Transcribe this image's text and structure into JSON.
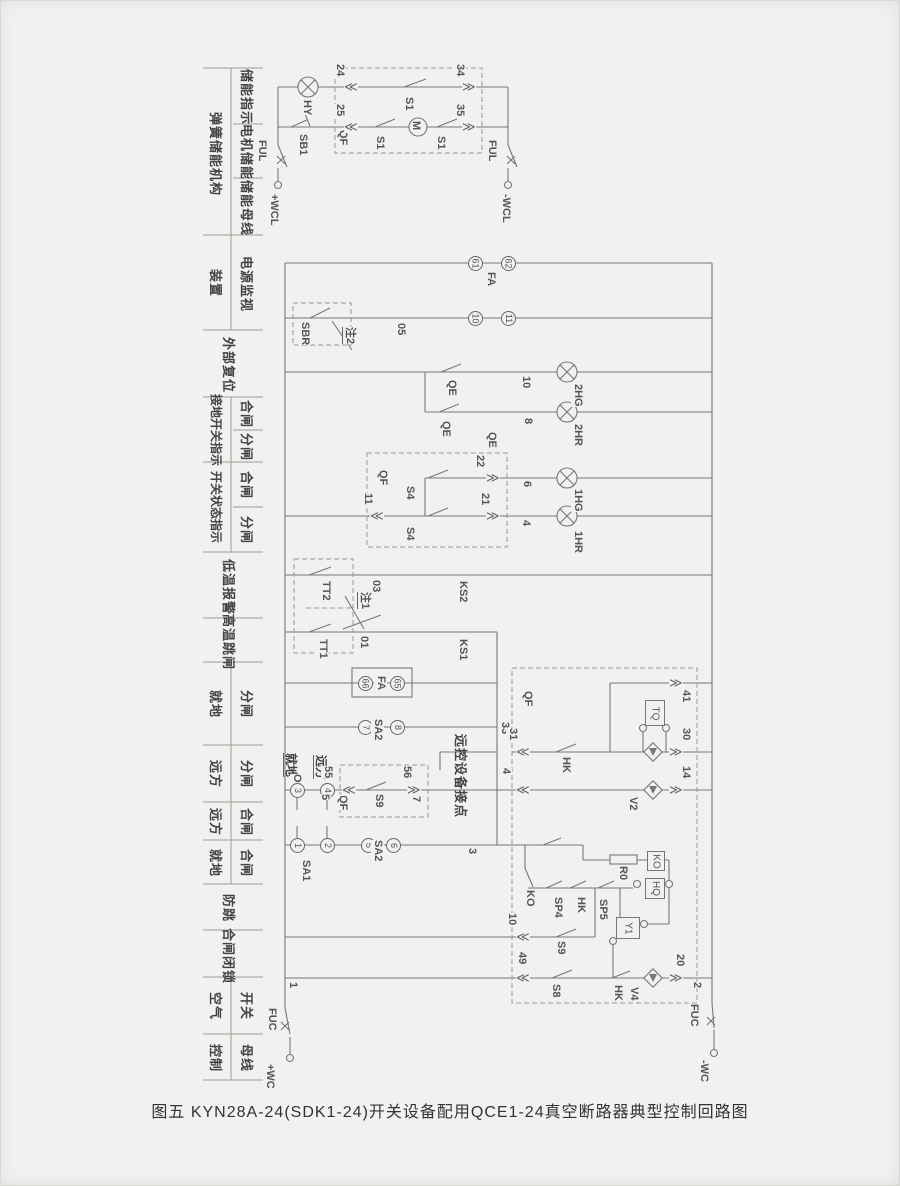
{
  "caption": "图五 KYN28A-24(SDK1-24)开关设备配用QCE1-24真空断路器典型控制回路图",
  "colors": {
    "bg": "#f1f1ef",
    "line": "#777777",
    "text": "#4a4a4a"
  },
  "left_col": {
    "groups": [
      {
        "outer": "弹簧储能机构",
        "inner": [
          "储能指示",
          "电机储能",
          "储能母线"
        ]
      },
      {
        "outer": "装置",
        "inner": [
          "电源监视"
        ]
      },
      {
        "single": "外部复位"
      },
      {
        "outer": "接地开关指示",
        "inner": [
          "合闸",
          "分闸"
        ]
      },
      {
        "outer": "开关状态指示",
        "inner": [
          "合闸",
          "分闸"
        ]
      },
      {
        "single": "低温报警"
      },
      {
        "single": "高温跳闸"
      },
      {
        "outer": "就地",
        "inner": [
          "分闸"
        ]
      },
      {
        "outer": "远方",
        "inner": [
          "分闸"
        ]
      },
      {
        "outer": "远方",
        "inner": [
          "合闸"
        ]
      },
      {
        "outer": "就地",
        "inner": [
          "合闸"
        ]
      },
      {
        "single": "防跳"
      },
      {
        "single": "合闸闭锁"
      },
      {
        "outer": "空气",
        "inner": [
          "开关"
        ]
      },
      {
        "outer": "控制",
        "inner": [
          "母线"
        ]
      }
    ]
  },
  "d": {
    "FUL": "FUL",
    "FUC": "FUC",
    "WCLp": "+WCL",
    "WCLn": "-WCL",
    "WCp": "+WC",
    "WCn": "-WC",
    "HY": "HY",
    "SB1": "SB1",
    "QF": "QF",
    "S1": "S1",
    "M": "M",
    "n24": "24",
    "n25": "25",
    "n34": "34",
    "n35": "35",
    "FA": "FA",
    "SBR": "SBR",
    "note2": "注2",
    "n05": "05",
    "QE": "QE",
    "n10": "10",
    "n8": "8",
    "HG2": "2HG",
    "HR2": "2HR",
    "n11": "11",
    "S4": "S4",
    "n22": "22",
    "n21": "21",
    "n6": "6",
    "n4": "4",
    "HG1": "1HG",
    "HR1": "1HR",
    "TT2": "TT2",
    "TT1": "TT1",
    "note1": "注1",
    "n03": "03",
    "n01": "01",
    "KS2": "KS2",
    "KS1": "KS1",
    "SA2": "SA2",
    "SA1": "SA1",
    "n33": "33",
    "remote": "远控设备接点",
    "loc": "就地",
    "O": "O",
    "far": "远方",
    "n5": "5",
    "n55": "55",
    "S9": "S9",
    "n56": "56",
    "n7": "7",
    "n3": "3",
    "n31": "31",
    "HK": "HK",
    "n41": "41",
    "TQ": "TQ",
    "n30": "30",
    "V2": "V2",
    "n14": "14",
    "KO": "KO",
    "SP4": "SP4",
    "SP5": "SP5",
    "R0": "R0",
    "HQ": "HQ",
    "Y1": "Y1",
    "S8": "S8",
    "V4": "V4",
    "n20": "20",
    "n2": "2",
    "n49": "49",
    "n1": "1",
    "n61": "61",
    "n62": "62",
    "n66": "66",
    "n65": "65"
  }
}
